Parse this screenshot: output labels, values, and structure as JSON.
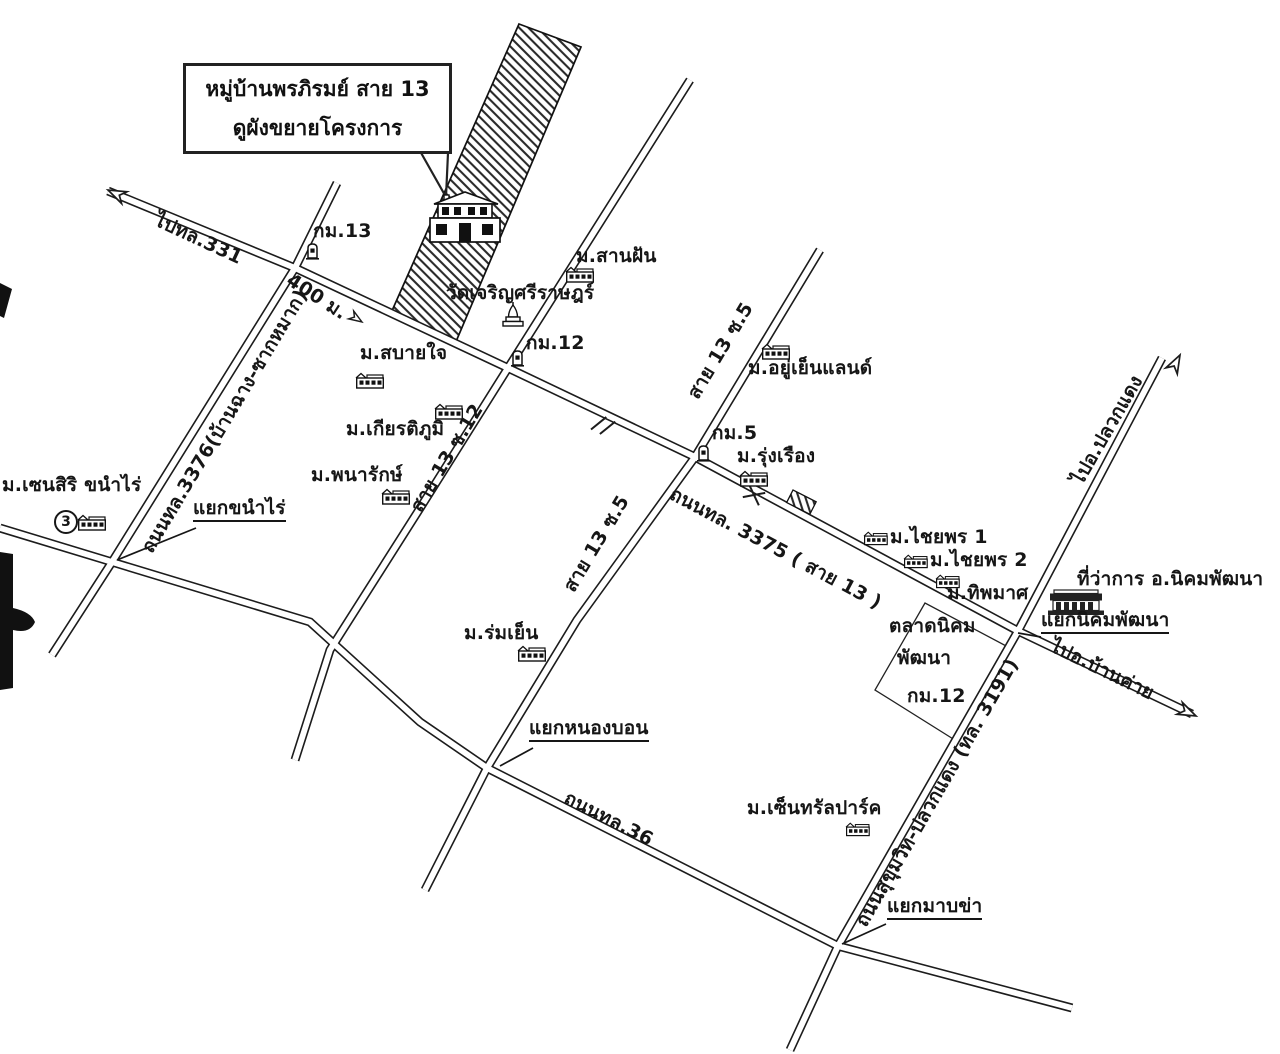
{
  "callout": {
    "line1": "หมู่บ้านพรภิรมย์ สาย 13",
    "line2": "ดูผังขยายโครงการ"
  },
  "roads": {
    "to_route_331": "ไปทล.331",
    "route_3376": "ถนนทล.3376(บ้านฉาง-ซากหมาก)",
    "distance_400m": "400 ม.",
    "route_3375": "ถนนทล. 3375 ( สาย 13 )",
    "soi_13_5_upper": "สาย 13 ซ.5",
    "soi_13_12": "สาย 13 ซ.12",
    "soi_13_5_lower": "สาย 13 ซ.5",
    "route_36": "ถนนทล.36",
    "route_3191": "ถนนสุขุมวิท-ปลวกแดง (ทล. 3191)",
    "to_pluak_daeng": "ไปอ.ปลวกแดง",
    "to_ban_khai": "ไปอ.บ้านค่าย"
  },
  "places": {
    "san_fan": "ม.สานฝัน",
    "wat": "วัดเจริญศรีราษฎร์",
    "sabai_jai": "ม.สบายใจ",
    "kiattiphum": "ม.เกียรติภูมิ",
    "phanarak": "ม.พนารักษ์",
    "sensiri": "ม.เซนสิริ ขนำไร่",
    "yu_yen_land": "ม.อยู่เย็นแลนด์",
    "rung_rueang": "ม.รุ่งเรือง",
    "chaiyaporn1": "ม.ไชยพร 1",
    "chaiyaporn2": "ม.ไชยพร 2",
    "thipamat": "ม.ทิพมาศ",
    "district_office": "ที่ว่าการ อ.นิคมพัฒนา",
    "market_line1": "ตลาดนิคม",
    "market_line2": "พัฒนา",
    "rom_yen": "ม.ร่มเย็น",
    "central_park": "ม.เซ็นทรัลปาร์ค"
  },
  "junctions": {
    "khanam_rai": "แยกขนำไร่",
    "nong_bon": "แยกหนองบอน",
    "map_kha": "แยกมาบข่า",
    "nikhom_phatthana": "แยกนิคมพัฒนา"
  },
  "milestones": {
    "km13": "กม.13",
    "km12": "กม.12",
    "km5": "กม.5",
    "km12_market": "กม.12"
  },
  "badge_number": "3"
}
